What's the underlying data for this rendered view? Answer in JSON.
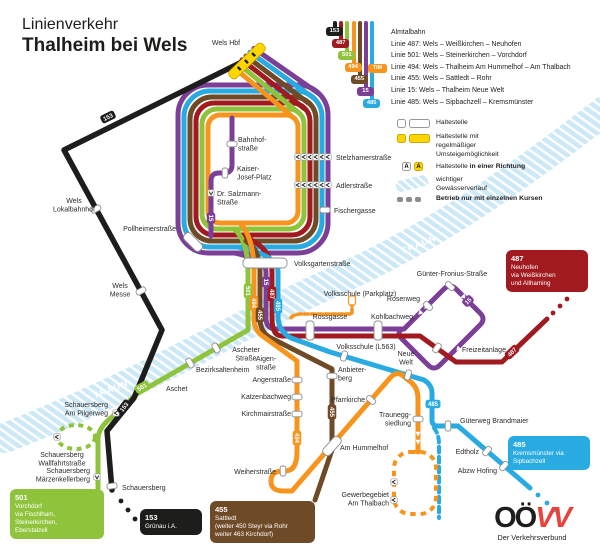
{
  "title": {
    "line1": "Linienverkehr",
    "line2": "Thalheim bei Wels"
  },
  "colors": {
    "almtalbahn": "#1d1d1b",
    "linie487": "#a01a20",
    "linie501": "#8fc33c",
    "linie494": "#f7941d",
    "linie455": "#6f4a27",
    "linie15": "#7c3f98",
    "linie485": "#29abe2",
    "interchange_yellow": "#ffd500",
    "river": "#cde9f7",
    "logo_red": "#e8423b"
  },
  "legend_lines": [
    {
      "num": "153",
      "label": "Almtalbahn"
    },
    {
      "num": "487",
      "label": "Linie 487: Wels – Weißkirchen – Neuhofen"
    },
    {
      "num": "501",
      "label": "Linie 501: Wels – Steinerkirchen – Vorchdorf"
    },
    {
      "num": "494",
      "label": "Linie 494: Wels – Thalheim Am Hummelhof – Am Thalbach",
      "prefix": "TIM"
    },
    {
      "num": "455",
      "label": "Linie 455: Wels – Sattledt – Rohr"
    },
    {
      "num": "15",
      "label": "Linie 15: Wels – Thalheim Neue Welt"
    },
    {
      "num": "485",
      "label": "Linie 485: Wels – Sipbachzell – Kremsmünster"
    }
  ],
  "legend_symbols": {
    "haltestelle": "Haltestelle",
    "umsteige": "Haltestelle mit\nregelmäßiger\nUmsteigemöglichkeit",
    "richtung_normal": "Haltestelle ",
    "richtung_bold": "in einer Richtung",
    "gewaesser": "wichtiger\nGewässerverlauf",
    "betrieb": "Betrieb nur mit einzelnen Kursen",
    "a_letter": "A"
  },
  "river": {
    "name": "TRAUN"
  },
  "badges": {
    "b153": "153",
    "b487": "487",
    "b501": "501",
    "b494": "494",
    "b455": "455",
    "b15": "15",
    "b485": "485"
  },
  "stations": {
    "wels_hbf": "Wels Hbf",
    "wels_lokalbahnhof": "Wels\nLokalbahnhof",
    "wels_messe": "Wels\nMesse",
    "schauersberg": "Schauersberg",
    "pollheimerstrasse": "Pollheimerstraße",
    "bahnhofstrasse": "Bahnhof-\nstraße",
    "kaiser_josef": "Kaiser-\nJosef-Platz",
    "salzmann": "Dr. Salzmann-\nStraße",
    "stelzhamerstrasse": "Stelzhamerstraße",
    "adlerstrasse": "Adlerstraße",
    "fischergasse": "Fischergasse",
    "volksgartenstrasse": "Volksgartenstraße",
    "volksschule_parkplatz": "Volksschule (Parkplatz)",
    "rossgasse": "Rossgasse",
    "kohlbachweg": "Kohlbachweg",
    "volksschule_l563": "Volksschule (L563)",
    "neue_welt": "Neue\nWelt",
    "guenter_fronius": "Günter-Fronius-Straße",
    "rosenweg": "Rosenweg",
    "freizeitanlage": "Freizeitanlage",
    "aigenstrasse": "Aigen-\nstraße",
    "angerstrasse": "Angerstraße",
    "katzenbachweg": "Katzenbachweg",
    "kirchmairstrasse": "Kirchmairstraße",
    "anbieterberg": "Anbieter-\nberg",
    "pfarrkirche": "Pfarrkirche",
    "traunegg": "Traunegg-\nsiedlung",
    "weiherstrasse": "Weiherstraße",
    "am_hummelhof": "Am Hummelhof",
    "gewerbegebiet": "Gewerbegebiet\nAm Thalbach",
    "gueterweg": "Güterweg Brandmaier",
    "edtholz": "Edtholz",
    "abzw_hofing": "Abzw Hofing",
    "ascheter": "Ascheter\nStraße",
    "bezirksaltenheim": "Bezirksaltenheim",
    "aschet": "Aschet",
    "pilgerweg": "Schauersberg\nAm Pilgerweg",
    "wallfahrt": "Schauersberg\nWallfahrtstraße",
    "maerzenkeller": "Schauersberg\nMärzenkellerberg"
  },
  "terminus_boxes": {
    "box501": {
      "num": "501",
      "desc": "Vorchdorf\nvia Fischlham,\nSteinerkirchen,\nEberstalzell"
    },
    "box153": {
      "num": "153",
      "desc": "Grünau i.A."
    },
    "box455": {
      "num": "455",
      "desc": "Sattledt\n(weiter 450 Steyr via Rohr\nweiter 463 Kirchdorf)"
    },
    "box487": {
      "num": "487",
      "desc": "Neuhofen\nvia Weißkirchen\nund Allhaming"
    },
    "box485": {
      "num": "485",
      "desc": "Kremsmünster via\nSipbachzell"
    }
  },
  "logo": {
    "oo": "OÖ",
    "vv": "VV",
    "sub": "Der Verkehrsverbund"
  }
}
